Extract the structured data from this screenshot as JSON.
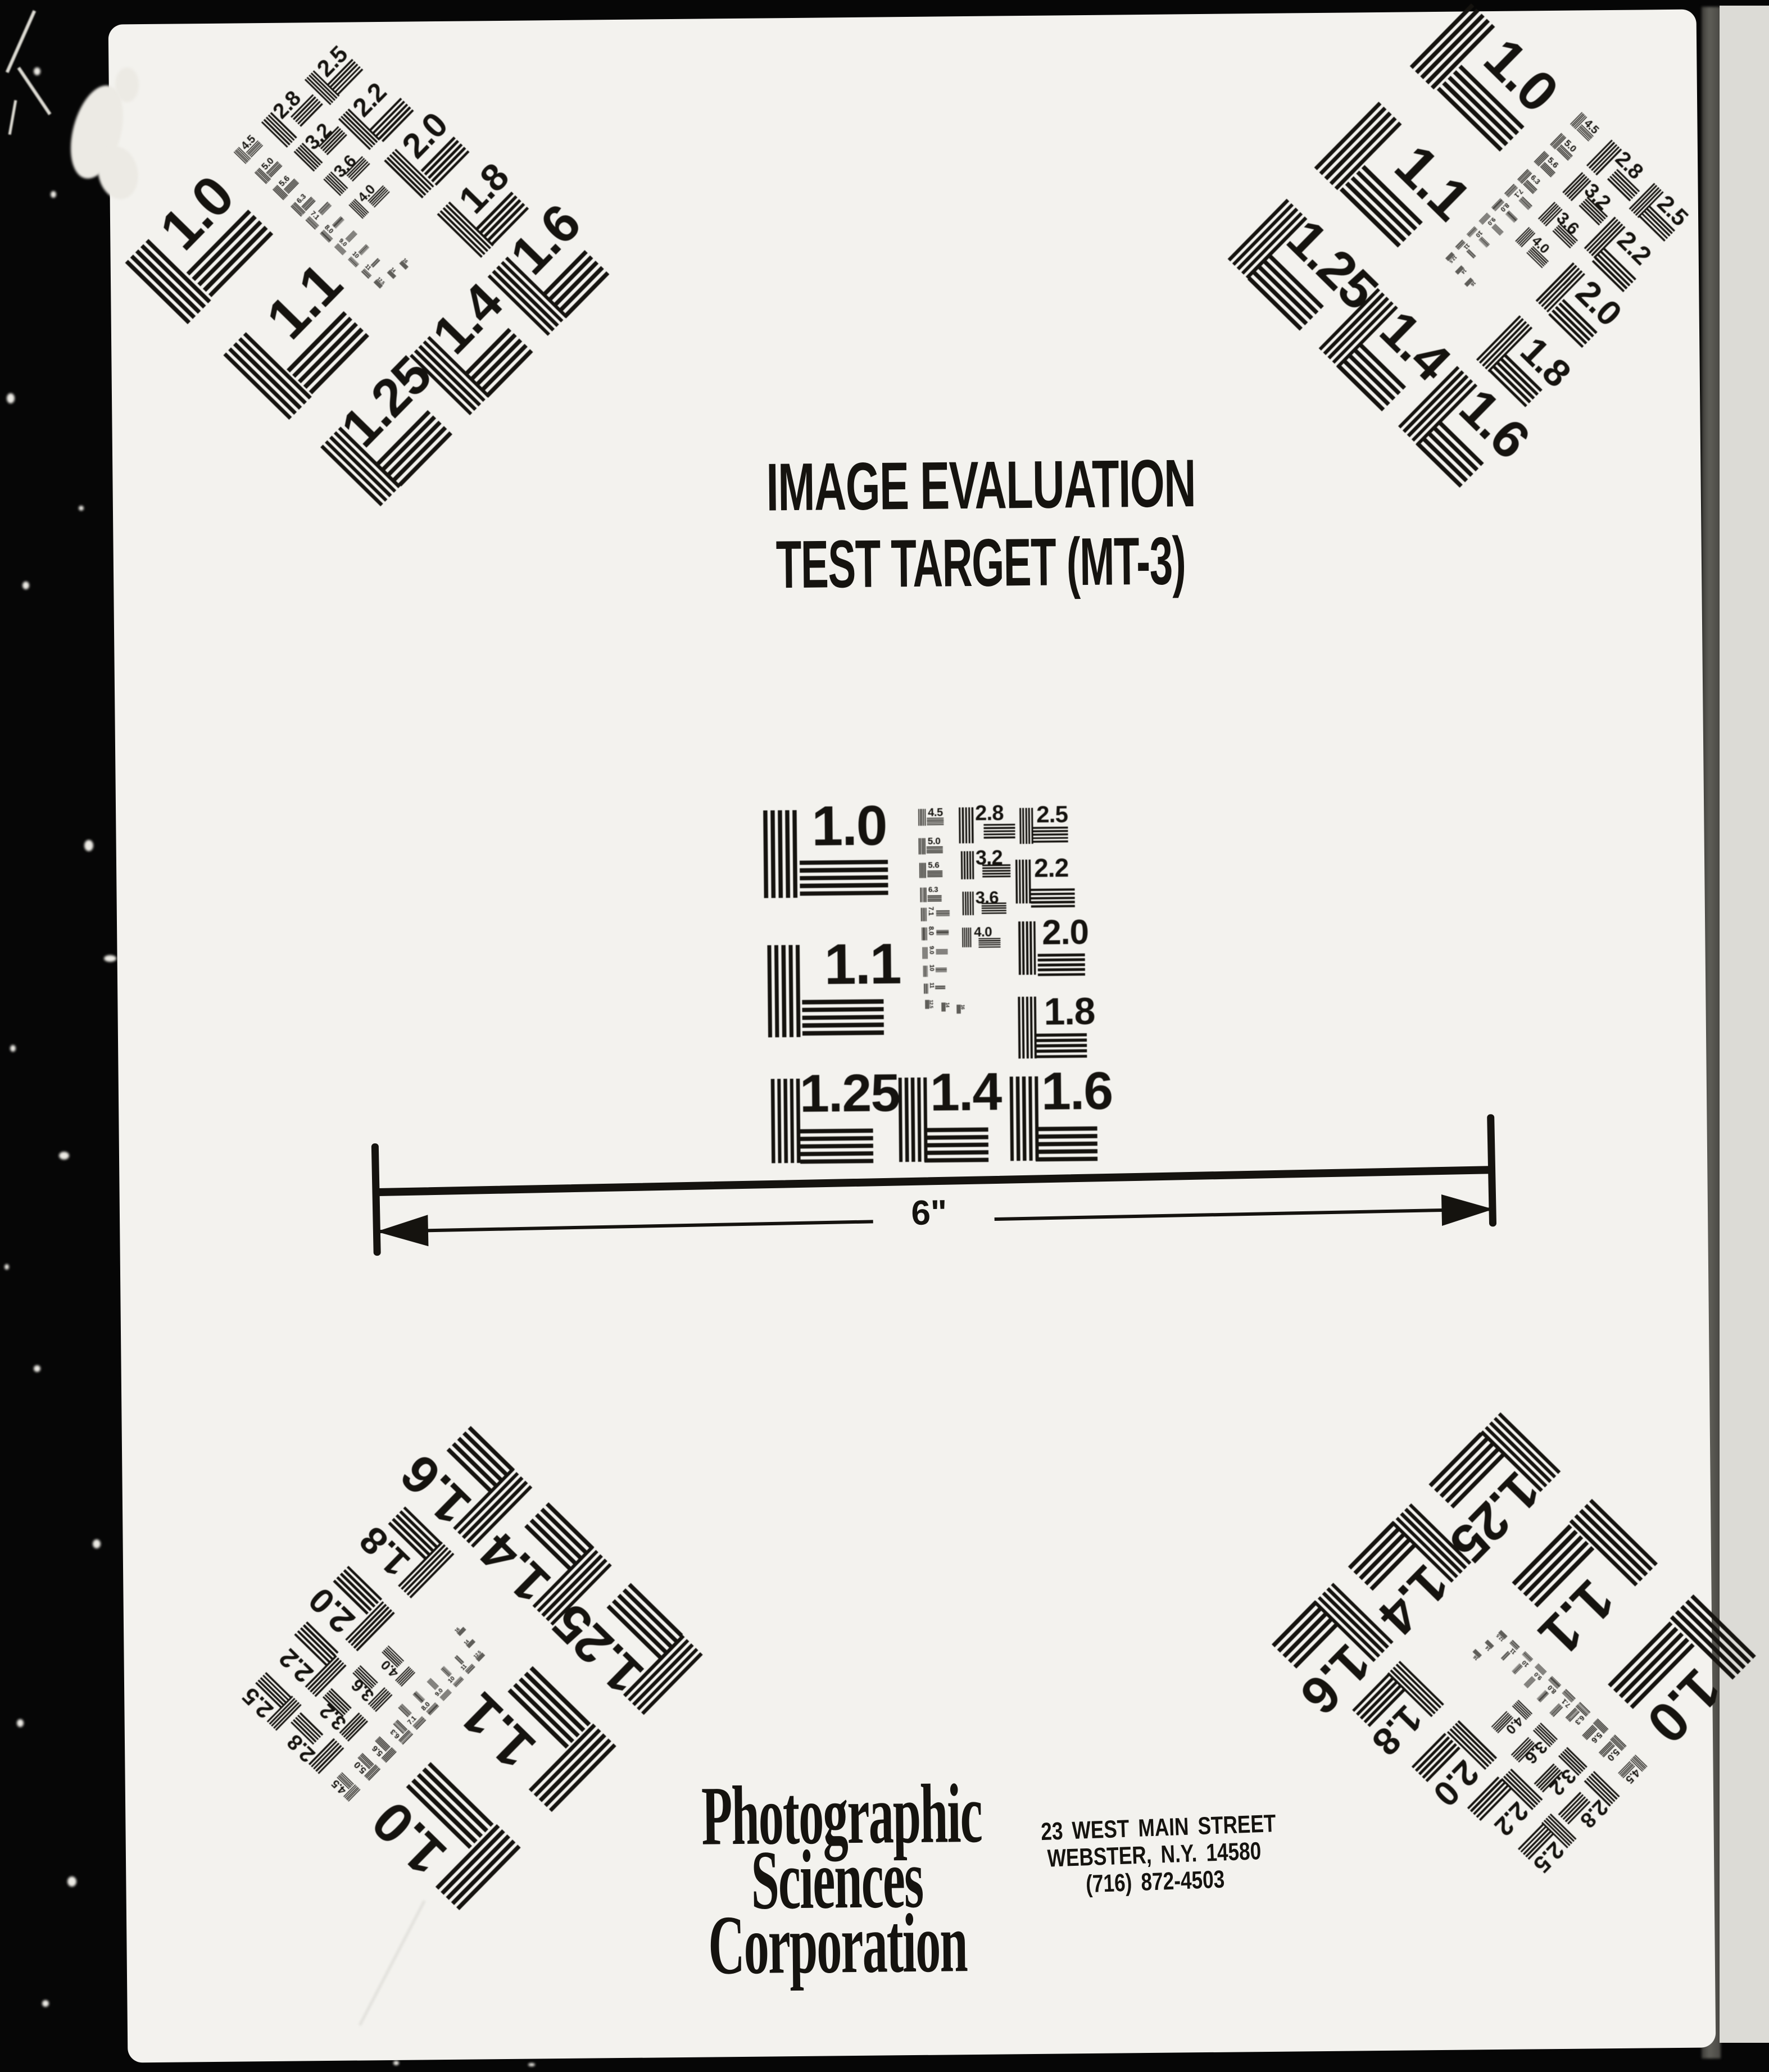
{
  "document": {
    "title_line1": "IMAGE EVALUATION",
    "title_line2": "TEST TARGET (MT-3)",
    "ruler_label": "6\"",
    "org_line1": "Photographic",
    "org_line2": "Sciences",
    "org_line3": "Corporation",
    "addr_line1": "23 WEST MAIN STREET",
    "addr_line2": "WEBSTER, N.Y. 14580",
    "addr_line3": "(716) 872-4503"
  },
  "test_pattern": {
    "large_labels": [
      "1.0",
      "1.1",
      "1.25",
      "1.4",
      "1.6"
    ],
    "right_labels": [
      "2.5",
      "2.2",
      "2.0",
      "1.8"
    ],
    "mid_labels": [
      "2.8",
      "3.2",
      "3.6",
      "4.0"
    ],
    "small_labels": [
      "4.5",
      "5.0",
      "5.6",
      "6.3",
      "7.1",
      "8.0",
      "9.0",
      "10",
      "11"
    ],
    "micro_labels": [
      "12.5",
      "14",
      "16"
    ],
    "instances": [
      "center",
      "top-left",
      "top-right",
      "bottom-left",
      "bottom-right"
    ]
  },
  "colors": {
    "ink": "#15130f",
    "page": "#f3f2ee",
    "film_black": "#060606",
    "edge_dark": "#54534e",
    "edge_light": "#dcdbd6"
  }
}
